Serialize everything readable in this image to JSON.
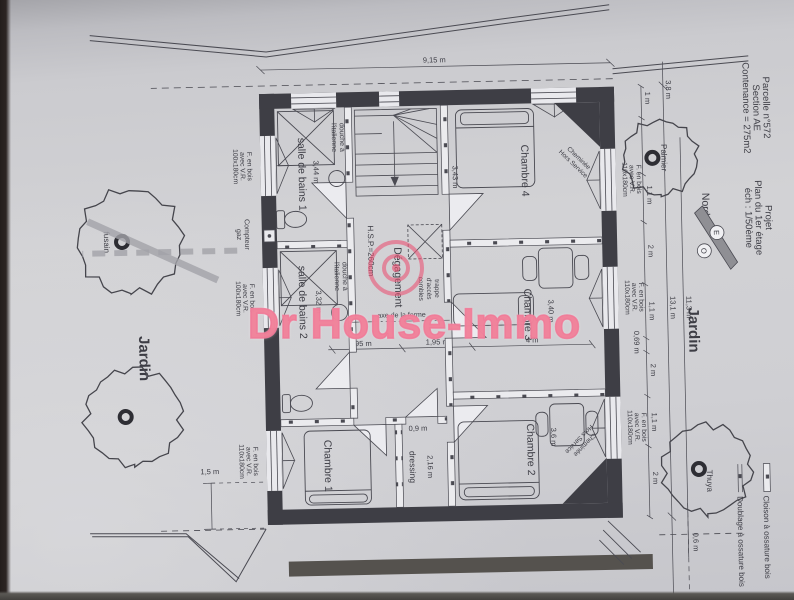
{
  "watermark": {
    "text": "Dr House-Immo",
    "color": "#e95474"
  },
  "title": {
    "parcel1": "Parcelle n°572",
    "parcel2": "Section AE",
    "parcel3": "Contenance = 275m2",
    "proj1": "Projet",
    "proj2": "Plan du 1er étage",
    "proj3": "éch : 1/50ème"
  },
  "legend": {
    "cloison": "Cloison à ossature bois",
    "doublage": "Doublage à ossature bois"
  },
  "compass": {
    "n": "Nord",
    "e": "E",
    "o": "O"
  },
  "garden": {
    "top": "Jardin",
    "bottom": "Jardin",
    "palmier": "Palmier",
    "thuya": "Thuya",
    "fusain": "fusain"
  },
  "rooms": {
    "ch1": "Chambre 1",
    "ch2": "Chambre 2",
    "ch3": "Chambre 3",
    "ch4": "Chambre 4",
    "sdb1": "salle de bains 1",
    "sdb2": "salle de bains 2",
    "deg": "Dégagement",
    "dressing": "dressing"
  },
  "labels": {
    "douche1": "douche à",
    "douche2": "l'italienne",
    "hsp": "H.S.P.=260cm",
    "trappe1": "trappe",
    "trappe2": "d'accès",
    "trappe3": "combles",
    "axe": "axe de la ferme",
    "chem1": "Cheminée",
    "chem2": "Hors Service",
    "compteur1": "Compteur",
    "compteur2": "gaz",
    "fb": "F. en bois",
    "vr": "avec V.R.",
    "s110": "110x180cm",
    "s100": "100x180cm"
  },
  "dims": {
    "d915": "9,15 m",
    "d131": "13,1 m",
    "d113": "11,3 m",
    "d38": "3,8 m",
    "d1": "1 m",
    "d11": "1,1 m",
    "d2": "2 m",
    "d069": "0,69 m",
    "d343": "3,43 m",
    "d340": "3,40 m",
    "d4": "4 m",
    "d36": "3,6 m",
    "d344": "3,44 m",
    "d332": "3,32 m",
    "d195": "1,95 m",
    "d09": "0,9 m",
    "d216": "2,16 m",
    "d15": "1,5 m",
    "d06": "0,6 m"
  }
}
